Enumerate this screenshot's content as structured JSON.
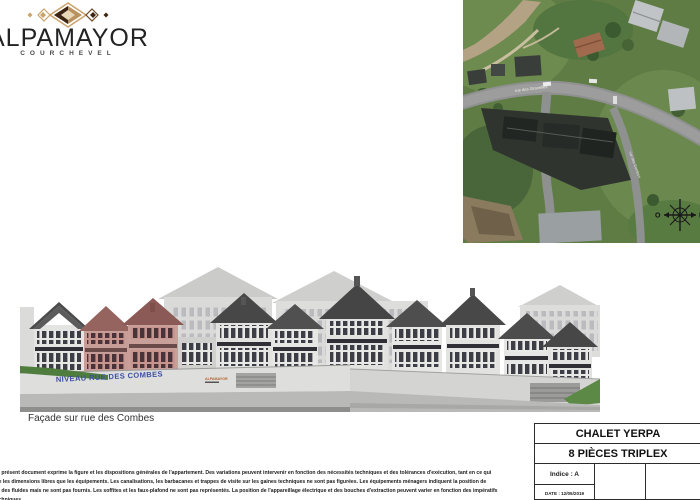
{
  "logo": {
    "brand": "ALPAMAYOR",
    "subtitle": "COURCHEVEL"
  },
  "aerial_map": {
    "road_label": "rue des Gravelles",
    "road_label_2": "rue des Combes",
    "compass": {
      "west": "O",
      "east": "E"
    }
  },
  "elevation": {
    "street_level_label": "NIVEAU RUE DES COMBES",
    "building_sign": "ALPAMAYOR",
    "caption": "Façade sur rue des Combes"
  },
  "disclaimer": {
    "lines": [
      "Le présent document exprime la figure et les dispositions générales de l'appartement. Des variations peuvent intervenir en fonction des nécessités techniques et des tolérances d'exécution, tant en ce qui",
      "me les dimensions libres que les équipements. Les canalisations, les barbacanes et trappes de visite sur les gaines techniques ne sont pas figurées. Les équipements ménagers indiquent la position de",
      "ge des fluides mais ne sont pas fournis. Les soffites et les faux-plafond ne sont pas représentés. La position de l'appareillage électrique et des bouches d'extraction peuvent varier en fonction des impératifs",
      "techniques."
    ]
  },
  "title_block": {
    "project": "CHALET YERPA",
    "unit": "8 PIÈCES TRIPLEX",
    "indice": "Indice : A",
    "date": "DATE : 12/05/2019"
  },
  "colors": {
    "highlight_red": "#8c5a56",
    "label_blue": "#3b4fa0",
    "logo_brown": "#b9925f"
  }
}
